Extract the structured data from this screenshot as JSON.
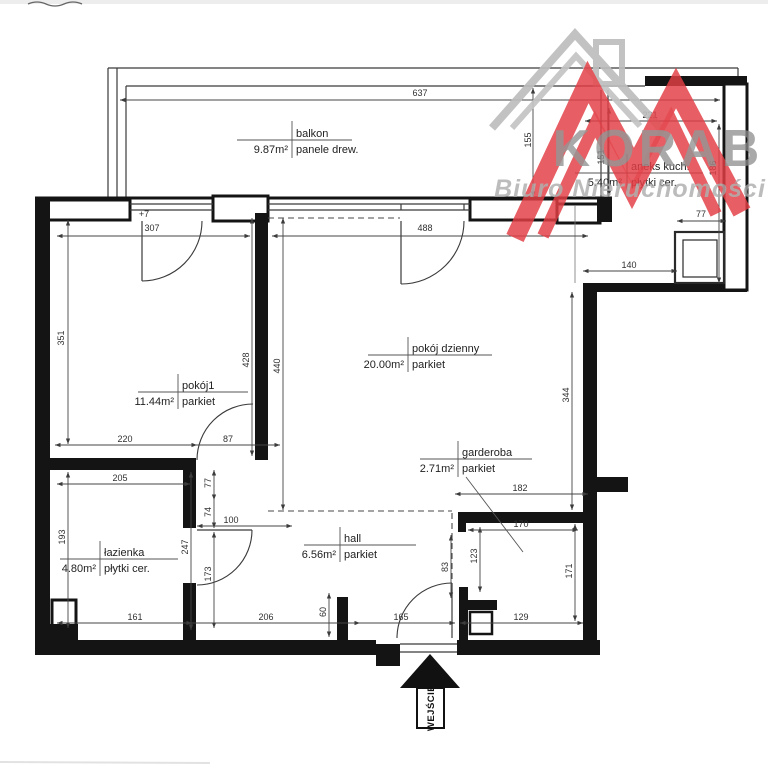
{
  "logo": {
    "brand": "KORAB",
    "subtitle": "Biuro Nieruchomości",
    "red": "#e23d44",
    "house_gray": "#bdbdbd",
    "text_gray": "#8d8d8d"
  },
  "entrance": {
    "label": "WEJŚCIE"
  },
  "rooms": [
    {
      "name": "balkon",
      "area": "9.87m²",
      "floor": "panele drew.",
      "vx": 292,
      "vy1": 121,
      "vy2": 158,
      "hx1": 237,
      "hx2": 352,
      "hy": 140,
      "nx": 296,
      "ny": 137,
      "ax": 288,
      "ay": 153,
      "fx": 296,
      "fy": 153
    },
    {
      "name": "aneks kuch.",
      "area": "5.40m²",
      "floor": "płytki cer.",
      "vx": 627,
      "vy1": 154,
      "vy2": 191,
      "hx1": 575,
      "hx2": 703,
      "hy": 173,
      "nx": 631,
      "ny": 170,
      "ax": 622,
      "ay": 186,
      "fx": 631,
      "fy": 186
    },
    {
      "name": "pokój dzienny",
      "area": "20.00m²",
      "floor": "parkiet",
      "vx": 408,
      "vy1": 337,
      "vy2": 372,
      "hx1": 368,
      "hx2": 492,
      "hy": 355,
      "nx": 412,
      "ny": 352,
      "ax": 404,
      "ay": 368,
      "fx": 412,
      "fy": 368
    },
    {
      "name": "pokój1",
      "area": "11.44m²",
      "floor": "parkiet",
      "vx": 178,
      "vy1": 374,
      "vy2": 409,
      "hx1": 138,
      "hx2": 248,
      "hy": 392,
      "nx": 182,
      "ny": 389,
      "ax": 174,
      "ay": 405,
      "fx": 182,
      "fy": 405
    },
    {
      "name": "garderoba",
      "area": "2.71m²",
      "floor": "parkiet",
      "vx": 458,
      "vy1": 441,
      "vy2": 477,
      "hx1": 420,
      "hx2": 532,
      "hy": 459,
      "nx": 462,
      "ny": 456,
      "ax": 454,
      "ay": 472,
      "fx": 462,
      "fy": 472,
      "leader": [
        466,
        477,
        523,
        552
      ]
    },
    {
      "name": "hall",
      "area": "6.56m²",
      "floor": "parkiet",
      "vx": 340,
      "vy1": 527,
      "vy2": 562,
      "hx1": 304,
      "hx2": 416,
      "hy": 545,
      "nx": 344,
      "ny": 542,
      "ax": 336,
      "ay": 558,
      "fx": 344,
      "fy": 558
    },
    {
      "name": "łazienka",
      "area": "4.80m²",
      "floor": "płytki cer.",
      "vx": 100,
      "vy1": 541,
      "vy2": 576,
      "hx1": 60,
      "hx2": 178,
      "hy": 559,
      "nx": 104,
      "ny": 556,
      "ax": 96,
      "ay": 572,
      "fx": 104,
      "fy": 572
    }
  ],
  "dimensions": [
    {
      "v": "637",
      "x": 420,
      "y": 96,
      "r": 0
    },
    {
      "v": "+7",
      "x": 144,
      "y": 217,
      "r": 0
    },
    {
      "v": "307",
      "x": 152,
      "y": 231,
      "r": 0
    },
    {
      "v": "488",
      "x": 425,
      "y": 231,
      "r": 0
    },
    {
      "v": "221",
      "x": 650,
      "y": 118,
      "r": 0
    },
    {
      "v": "77",
      "x": 701,
      "y": 217,
      "r": 0
    },
    {
      "v": "140",
      "x": 629,
      "y": 268,
      "r": 0
    },
    {
      "v": "155",
      "x": 531,
      "y": 140,
      "r": 1
    },
    {
      "v": "151",
      "x": 604,
      "y": 157,
      "r": 1
    },
    {
      "v": "186",
      "x": 716,
      "y": 168,
      "r": 1
    },
    {
      "v": "351",
      "x": 64,
      "y": 338,
      "r": 1
    },
    {
      "v": "428",
      "x": 249,
      "y": 360,
      "r": 1
    },
    {
      "v": "440",
      "x": 280,
      "y": 366,
      "r": 1
    },
    {
      "v": "344",
      "x": 569,
      "y": 395,
      "r": 1
    },
    {
      "v": "220",
      "x": 125,
      "y": 442,
      "r": 0
    },
    {
      "v": "87",
      "x": 228,
      "y": 442,
      "r": 0
    },
    {
      "v": "205",
      "x": 120,
      "y": 481,
      "r": 0
    },
    {
      "v": "193",
      "x": 65,
      "y": 537,
      "r": 1
    },
    {
      "v": "247",
      "x": 188,
      "y": 547,
      "r": 1
    },
    {
      "v": "77",
      "x": 211,
      "y": 483,
      "r": 1
    },
    {
      "v": "74",
      "x": 211,
      "y": 512,
      "r": 1
    },
    {
      "v": "100",
      "x": 231,
      "y": 523,
      "r": 0
    },
    {
      "v": "173",
      "x": 211,
      "y": 574,
      "r": 1
    },
    {
      "v": "161",
      "x": 135,
      "y": 620,
      "r": 0
    },
    {
      "v": "206",
      "x": 266,
      "y": 620,
      "r": 0
    },
    {
      "v": "165",
      "x": 401,
      "y": 620,
      "r": 0
    },
    {
      "v": "129",
      "x": 521,
      "y": 620,
      "r": 0
    },
    {
      "v": "60",
      "x": 326,
      "y": 612,
      "r": 1
    },
    {
      "v": "83",
      "x": 448,
      "y": 567,
      "r": 1
    },
    {
      "v": "123",
      "x": 477,
      "y": 556,
      "r": 1
    },
    {
      "v": "171",
      "x": 572,
      "y": 571,
      "r": 1
    },
    {
      "v": "170",
      "x": 521,
      "y": 527,
      "r": 0
    },
    {
      "v": "182",
      "x": 520,
      "y": 491,
      "r": 0
    }
  ]
}
